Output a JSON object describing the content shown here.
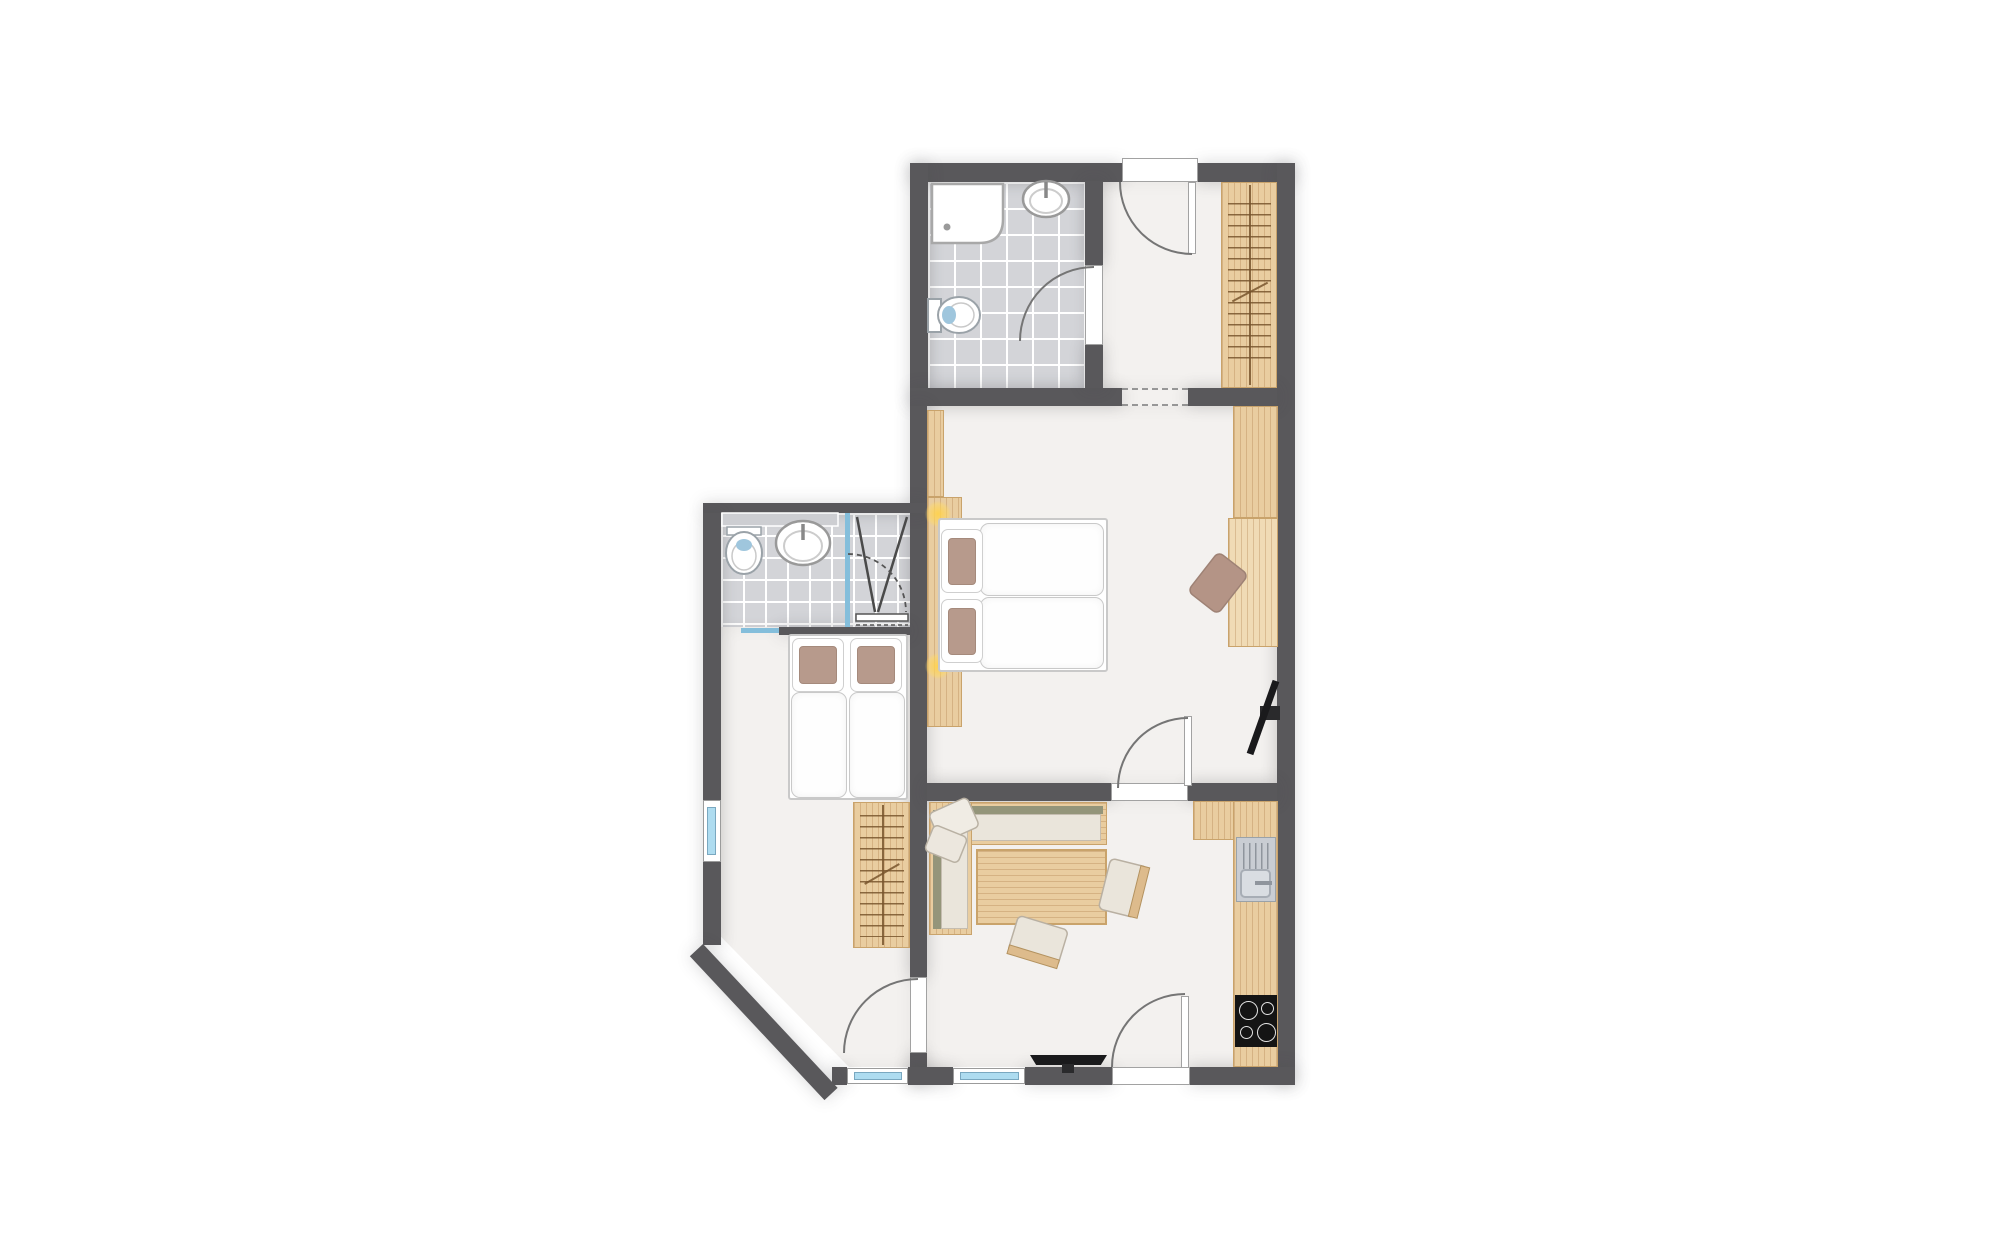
{
  "title": "apartment-floor-plan",
  "palette": {
    "wall": "#59585b",
    "floor": "#f3f1ef",
    "outside": "#ffffff",
    "tile": "#d3d4d8",
    "grout": "#ffffff",
    "wood": "#e9cda0",
    "wood-grain": "#a6733f",
    "wood-edge": "#c9a36b",
    "wood-light": "#f0dbb5",
    "olive": "#94957a",
    "seat": "#eae5db",
    "cushion": "#f0ece4",
    "cushion-edge": "#b9b1a3",
    "pillow": "#b79a8c",
    "linen": "#ffffff",
    "linen-edge": "#c9c9c9",
    "win-blue": "#aedcf0",
    "win-frame": "#9b9b9b",
    "glass": "#84bedb",
    "fix-white": "#ffffff",
    "fix-edge": "#9aa2a8",
    "water": "#9fc6dd",
    "counter": "#cdced2",
    "sink": "#c9cdd3",
    "basin": "#d9dde2",
    "metal": "#8f959d",
    "cook": "#141414",
    "ring": "#e3e3e3",
    "tv": "#1a1a1c",
    "doorline": "#757575",
    "dash": "#979797",
    "lamp": "#ffd24d"
  },
  "rooms": [
    {
      "id": "bathroom",
      "label": "tiled bathroom with shower, washbasin and toilet"
    },
    {
      "id": "hallway",
      "label": "entrance hallway with wardrobe and open passage"
    },
    {
      "id": "main-bedroom",
      "label": "bedroom with double bed, headboard lamps, wardrobe, desk and wall TV"
    },
    {
      "id": "ensuite",
      "label": "en-suite shower room with toilet, washbasin and glass shower"
    },
    {
      "id": "second-bedroom",
      "label": "bedroom with twin bed, wardrobe, corner window wall"
    },
    {
      "id": "living-room",
      "label": "living room with corner bench, dining table, TV and kitchenette"
    }
  ],
  "details": {
    "cooktop_burners": 4,
    "windows": 4,
    "door_swings": 5,
    "open_passages": 1
  }
}
